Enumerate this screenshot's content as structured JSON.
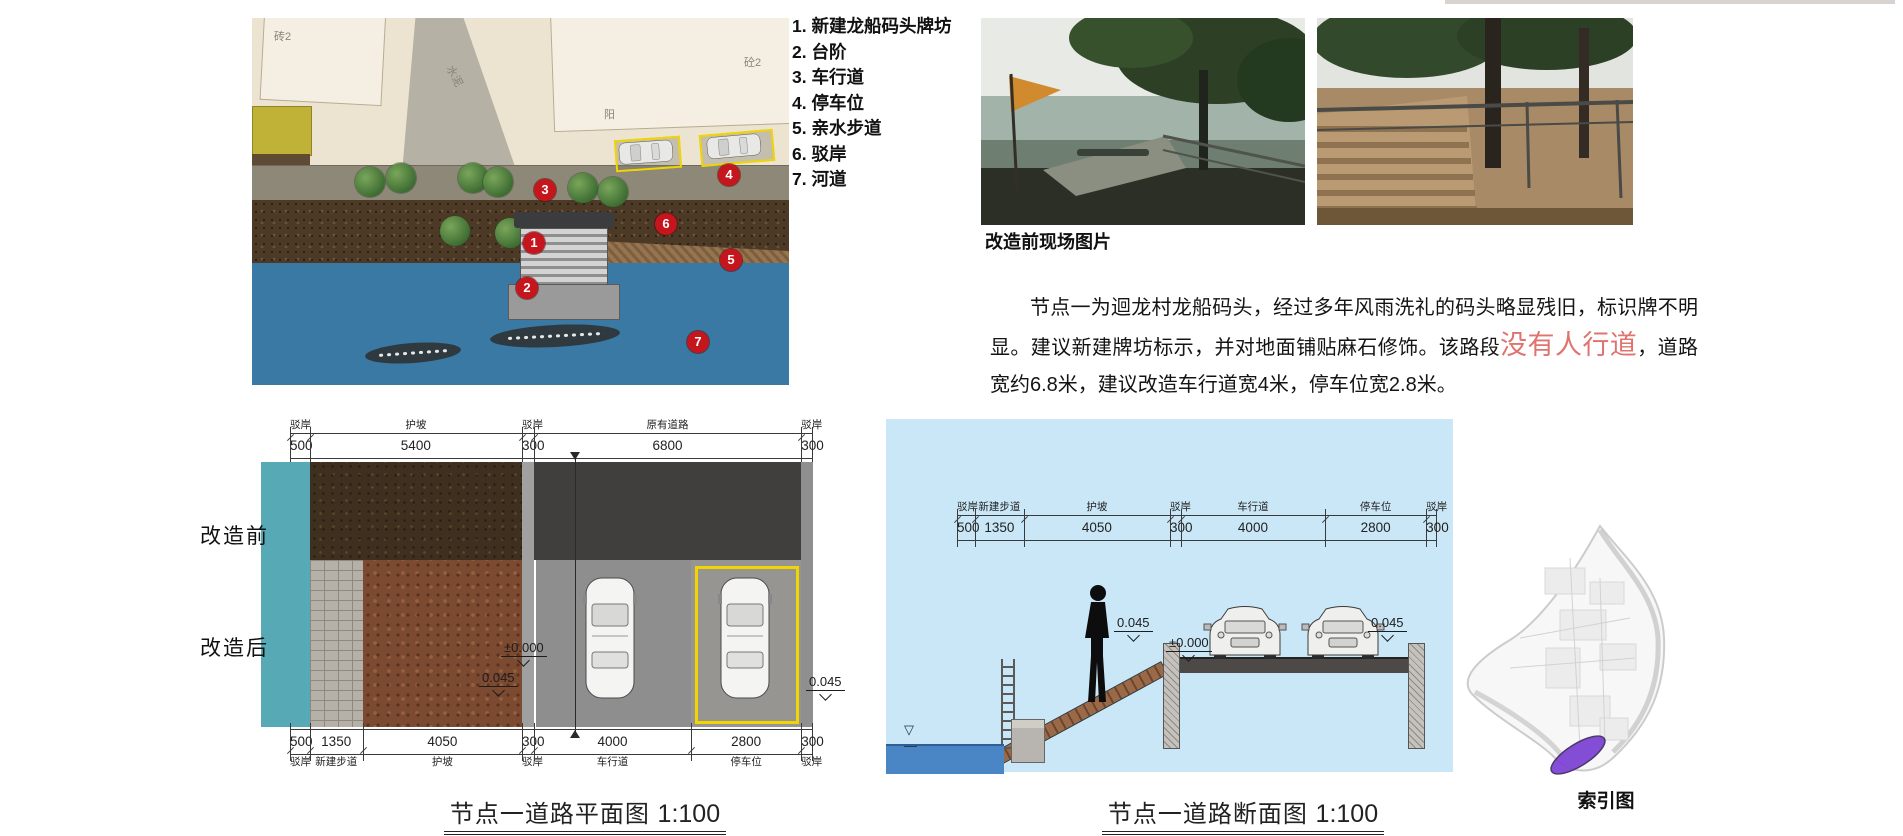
{
  "colors": {
    "marker_red": "#c4161c",
    "highlight_red": "#e0736e",
    "river_blue": "#3a79a3",
    "section_sky_blue": "#c9e7f7",
    "embankment_teal": "#57a9b6",
    "parking_yellow": "#f2d400",
    "index_purple": "#7b3fd4"
  },
  "site_plan": {
    "markers": [
      "1",
      "2",
      "3",
      "4",
      "5",
      "6",
      "7"
    ],
    "area_labels": [
      "砖2",
      "水泥",
      "阳",
      "砼2"
    ]
  },
  "legend": {
    "items": [
      "1. 新建龙船码头牌坊",
      "2. 台阶",
      "3. 车行道",
      "4. 停车位",
      "5. 亲水步道",
      "6. 驳岸",
      "7. 河道"
    ]
  },
  "photos": {
    "caption": "改造前现场图片"
  },
  "description": {
    "part1": "节点一为迴龙村龙船码头，经过多年风雨洗礼的码头略显残旧，标识牌不明显。建议新建牌坊标示，并对地面铺贴麻石修饰。该路段",
    "highlight": "没有人行道",
    "part2": "，道路宽约6.8米，建议改造车行道宽4米，停车位宽2.8米。"
  },
  "plan_diagram": {
    "side_label_before": "改造前",
    "side_label_after": "改造后",
    "top_dims": [
      {
        "label": "驳岸",
        "value": "500"
      },
      {
        "label": "护坡",
        "value": "5400"
      },
      {
        "label": "驳岸",
        "value": "300"
      },
      {
        "label": "原有道路",
        "value": "6800"
      },
      {
        "label": "驳岸",
        "value": "300"
      }
    ],
    "bottom_dims": [
      {
        "label": "驳岸",
        "value": "500"
      },
      {
        "label": "新建步道",
        "value": "1350"
      },
      {
        "label": "护坡",
        "value": "4050"
      },
      {
        "label": "驳岸",
        "value": "300"
      },
      {
        "label": "车行道",
        "value": "4000"
      },
      {
        "label": "停车位",
        "value": "2800"
      },
      {
        "label": "驳岸",
        "value": "300"
      }
    ],
    "elevations": {
      "zero": "±0.000",
      "left": "0.045",
      "right": "0.045"
    },
    "caption": "节点一道路平面图",
    "scale": "1:100"
  },
  "section_diagram": {
    "dims": [
      {
        "label": "驳岸",
        "value": "500"
      },
      {
        "label": "新建步道",
        "value": "1350"
      },
      {
        "label": "护坡",
        "value": "4050"
      },
      {
        "label": "驳岸",
        "value": "300"
      },
      {
        "label": "车行道",
        "value": "4000"
      },
      {
        "label": "停车位",
        "value": "2800"
      },
      {
        "label": "驳岸",
        "value": "300"
      }
    ],
    "elevations": {
      "left": "0.045",
      "zero": "±0.000",
      "right": "0.045"
    },
    "caption": "节点一道路断面图",
    "scale": "1:100"
  },
  "index_map": {
    "caption": "索引图"
  }
}
